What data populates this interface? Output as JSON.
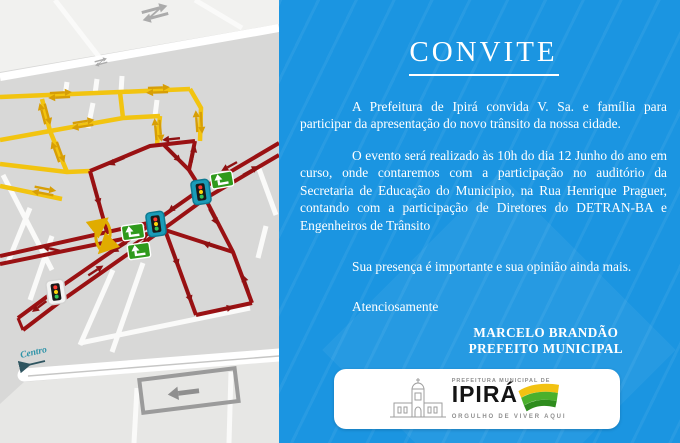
{
  "invite": {
    "title": "CONVITE",
    "paragraphs": {
      "p1": "A Prefeitura de Ipirá convida V. Sa. e família para participar da apresentação do novo trânsito da nossa cidade.",
      "p2": "O evento será realizado às 10h do dia 12 Junho do ano em curso, onde contaremos com a participação no auditório da Secretaria de Educação do Municipio, na Rua Henrique Praguer, contando com a participação de Diretores do DETRAN-BA e Engenheiros de Trânsito",
      "p3": "Sua presença é importante e sua opinião ainda mais."
    },
    "closing": "Atenciosamente",
    "signature": {
      "name": "MARCELO BRANDÃO",
      "role": "PREFEITO MUNICIPAL"
    }
  },
  "logo": {
    "pre": "PREFEITURA MUNICIPAL DE",
    "city": "IPIRÁ",
    "slogan": "ORGULHO DE VIVER AQUI"
  },
  "map": {
    "centro_label": "Centro",
    "icons": {
      "traffic_light": "traffic-light-icon",
      "turn_sign": "turn-sign-icon",
      "two_way_arrow": "two-way-arrow-icon",
      "one_way_arrow": "one-way-arrow-icon"
    },
    "colors": {
      "panel_blue": "#1b95e1",
      "two_way_road_yellow": "#f2c410",
      "one_way_road_red": "#9a1113",
      "traffic_light_teal": "#1a9cb8",
      "sign_green": "#2f9a1c"
    }
  }
}
